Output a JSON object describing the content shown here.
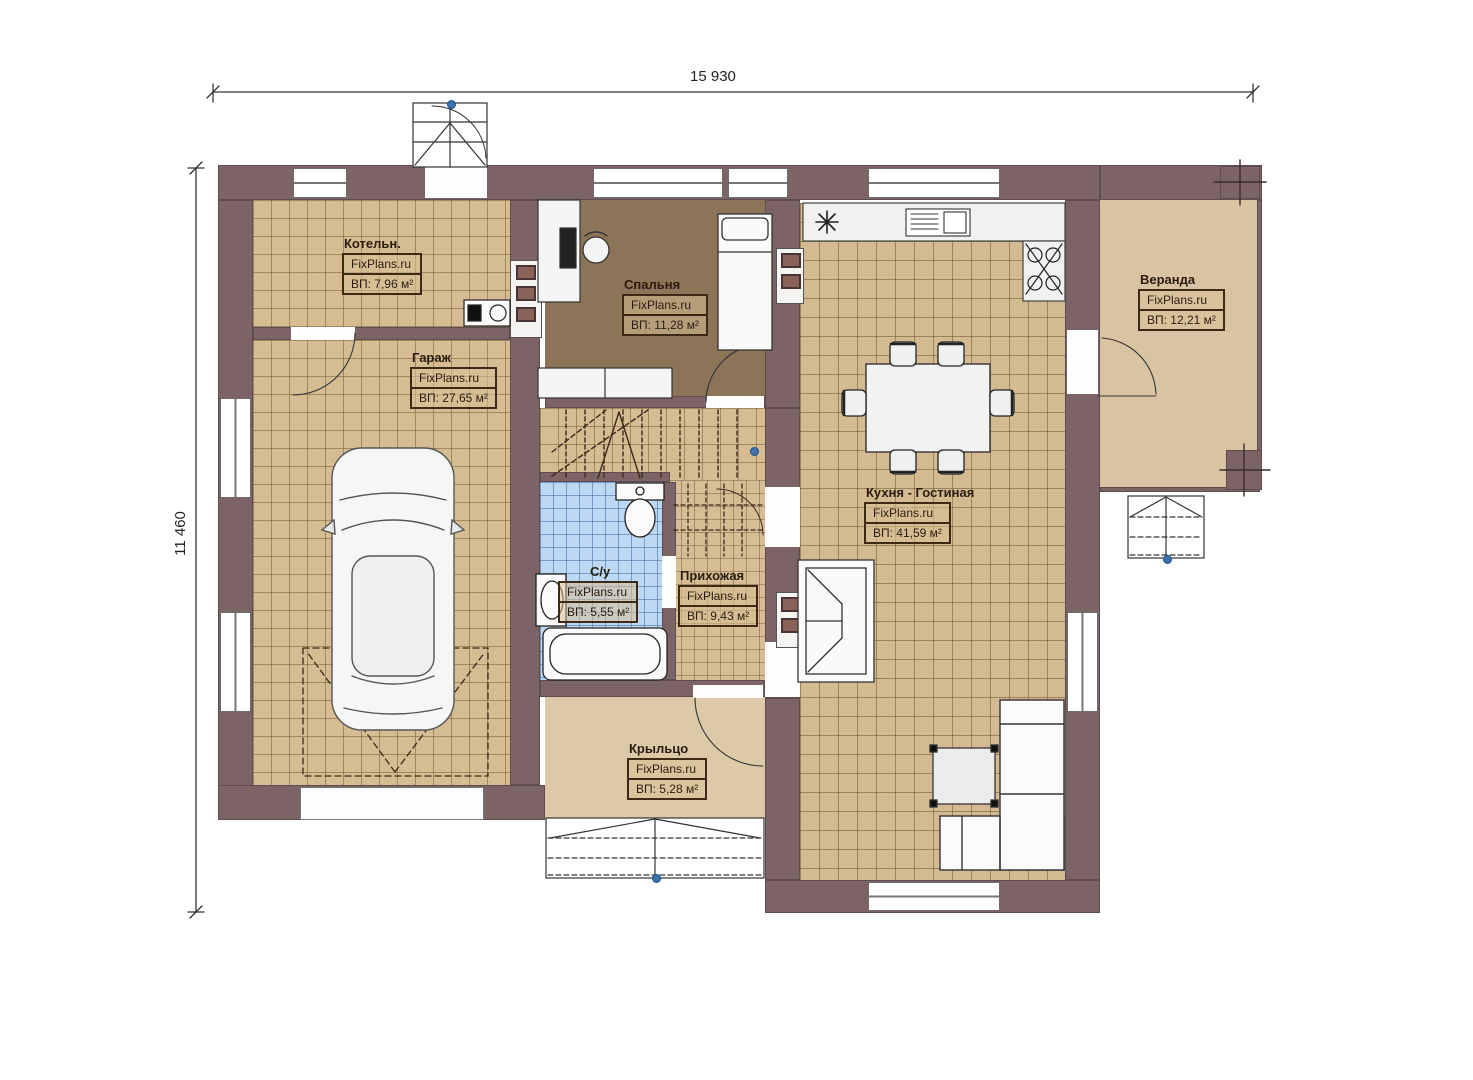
{
  "dimensions": {
    "width": "15 930",
    "height": "11 460"
  },
  "rooms": [
    {
      "id": "kotelnaya",
      "name": "Котельн.",
      "watermark": "FixPlans.ru",
      "area": "ВП: 7,96 м²"
    },
    {
      "id": "garage",
      "name": "Гараж",
      "watermark": "FixPlans.ru",
      "area": "ВП: 27,65 м²"
    },
    {
      "id": "bedroom",
      "name": "Спальня",
      "watermark": "FixPlans.ru",
      "area": "ВП: 11,28 м²"
    },
    {
      "id": "kitchen",
      "name": "Кухня - Гостиная",
      "watermark": "FixPlans.ru",
      "area": "ВП: 41,59 м²"
    },
    {
      "id": "veranda",
      "name": "Веранда",
      "watermark": "FixPlans.ru",
      "area": "ВП: 12,21 м²"
    },
    {
      "id": "bathroom",
      "name": "С/у",
      "watermark": "FixPlans.ru",
      "area": "ВП: 5,55 м²"
    },
    {
      "id": "hallway",
      "name": "Прихожая",
      "watermark": "FixPlans.ru",
      "area": "ВП: 9,43 м²"
    },
    {
      "id": "porch",
      "name": "Крыльцо",
      "watermark": "FixPlans.ru",
      "area": "ВП: 5,28 м²"
    }
  ],
  "colors": {
    "wall": "#7c6365",
    "floor_tile": "#d5bc92",
    "bedroom_floor": "#8c7458",
    "bathroom_tile": "#bdd8f2",
    "veranda_floor": "#d8c4a2",
    "node_dot": "#3f72ab",
    "label_border": "#3c2a16"
  }
}
